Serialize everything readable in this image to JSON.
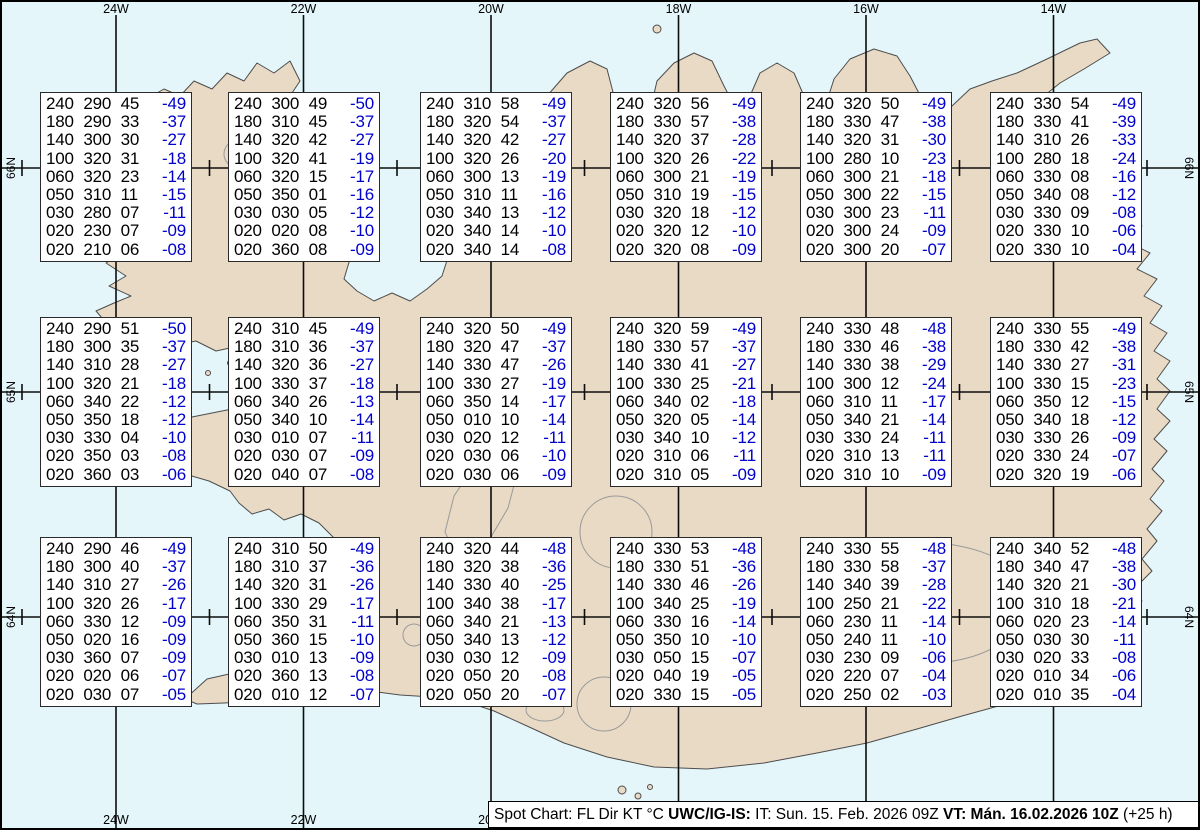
{
  "graticule": {
    "meridian_labels": [
      "24W",
      "22W",
      "20W",
      "18W",
      "16W",
      "14W"
    ],
    "parallel_labels": [
      "66N",
      "65N",
      "64N"
    ]
  },
  "legend": {
    "plain1": "Spot Chart: FL Dir KT °C ",
    "bold1": "UWC/IG-IS:",
    "plain2": " IT: Sun. 15. Feb. 2026 09Z ",
    "bold2": "VT: Mán. 16.02.2026 10Z",
    "plain3": " (+25 h)"
  },
  "colors": {
    "ocean": "#e4f6fa",
    "land": "#e9dac5",
    "coastline": "#4d4d4d",
    "glacier_outline": "#9a9a9a",
    "grid": "#0d0d0d",
    "temperature_blue": "#0000cc"
  },
  "columns": [
    "FL",
    "Dir",
    "KT",
    "°C"
  ],
  "spot_boxes": [
    {
      "row": 1,
      "col": 1,
      "rows": [
        [
          "240",
          "290",
          "45",
          "-49"
        ],
        [
          "180",
          "290",
          "33",
          "-37"
        ],
        [
          "140",
          "300",
          "30",
          "-27"
        ],
        [
          "100",
          "320",
          "31",
          "-18"
        ],
        [
          "060",
          "320",
          "23",
          "-14"
        ],
        [
          "050",
          "310",
          "11",
          "-15"
        ],
        [
          "030",
          "280",
          "07",
          "-11"
        ],
        [
          "020",
          "230",
          "07",
          "-09"
        ],
        [
          "020",
          "210",
          "06",
          "-08"
        ]
      ]
    },
    {
      "row": 1,
      "col": 2,
      "rows": [
        [
          "240",
          "300",
          "49",
          "-50"
        ],
        [
          "180",
          "310",
          "45",
          "-37"
        ],
        [
          "140",
          "320",
          "42",
          "-27"
        ],
        [
          "100",
          "320",
          "41",
          "-19"
        ],
        [
          "060",
          "320",
          "15",
          "-17"
        ],
        [
          "050",
          "350",
          "01",
          "-16"
        ],
        [
          "030",
          "030",
          "05",
          "-12"
        ],
        [
          "020",
          "020",
          "08",
          "-10"
        ],
        [
          "020",
          "360",
          "08",
          "-09"
        ]
      ]
    },
    {
      "row": 1,
      "col": 3,
      "rows": [
        [
          "240",
          "310",
          "58",
          "-49"
        ],
        [
          "180",
          "320",
          "54",
          "-37"
        ],
        [
          "140",
          "320",
          "42",
          "-27"
        ],
        [
          "100",
          "320",
          "26",
          "-20"
        ],
        [
          "060",
          "300",
          "13",
          "-19"
        ],
        [
          "050",
          "310",
          "11",
          "-16"
        ],
        [
          "030",
          "340",
          "13",
          "-12"
        ],
        [
          "020",
          "340",
          "14",
          "-10"
        ],
        [
          "020",
          "340",
          "14",
          "-08"
        ]
      ]
    },
    {
      "row": 1,
      "col": 4,
      "rows": [
        [
          "240",
          "320",
          "56",
          "-49"
        ],
        [
          "180",
          "330",
          "57",
          "-38"
        ],
        [
          "140",
          "320",
          "37",
          "-28"
        ],
        [
          "100",
          "320",
          "26",
          "-22"
        ],
        [
          "060",
          "300",
          "21",
          "-19"
        ],
        [
          "050",
          "310",
          "19",
          "-15"
        ],
        [
          "030",
          "320",
          "18",
          "-12"
        ],
        [
          "020",
          "320",
          "12",
          "-10"
        ],
        [
          "020",
          "320",
          "08",
          "-09"
        ]
      ]
    },
    {
      "row": 1,
      "col": 5,
      "rows": [
        [
          "240",
          "320",
          "50",
          "-49"
        ],
        [
          "180",
          "330",
          "47",
          "-38"
        ],
        [
          "140",
          "320",
          "31",
          "-30"
        ],
        [
          "100",
          "280",
          "10",
          "-23"
        ],
        [
          "060",
          "300",
          "21",
          "-18"
        ],
        [
          "050",
          "300",
          "22",
          "-15"
        ],
        [
          "030",
          "300",
          "23",
          "-11"
        ],
        [
          "020",
          "300",
          "24",
          "-09"
        ],
        [
          "020",
          "300",
          "20",
          "-07"
        ]
      ]
    },
    {
      "row": 1,
      "col": 6,
      "rows": [
        [
          "240",
          "330",
          "54",
          "-49"
        ],
        [
          "180",
          "330",
          "41",
          "-39"
        ],
        [
          "140",
          "310",
          "26",
          "-33"
        ],
        [
          "100",
          "280",
          "18",
          "-24"
        ],
        [
          "060",
          "330",
          "08",
          "-16"
        ],
        [
          "050",
          "340",
          "08",
          "-12"
        ],
        [
          "030",
          "330",
          "09",
          "-08"
        ],
        [
          "020",
          "330",
          "10",
          "-06"
        ],
        [
          "020",
          "330",
          "10",
          "-04"
        ]
      ]
    },
    {
      "row": 2,
      "col": 1,
      "rows": [
        [
          "240",
          "290",
          "51",
          "-50"
        ],
        [
          "180",
          "300",
          "35",
          "-37"
        ],
        [
          "140",
          "310",
          "28",
          "-27"
        ],
        [
          "100",
          "320",
          "21",
          "-18"
        ],
        [
          "060",
          "340",
          "22",
          "-12"
        ],
        [
          "050",
          "350",
          "18",
          "-12"
        ],
        [
          "030",
          "330",
          "04",
          "-10"
        ],
        [
          "020",
          "350",
          "03",
          "-08"
        ],
        [
          "020",
          "360",
          "03",
          "-06"
        ]
      ]
    },
    {
      "row": 2,
      "col": 2,
      "rows": [
        [
          "240",
          "310",
          "45",
          "-49"
        ],
        [
          "180",
          "310",
          "36",
          "-37"
        ],
        [
          "140",
          "320",
          "36",
          "-27"
        ],
        [
          "100",
          "330",
          "37",
          "-18"
        ],
        [
          "060",
          "340",
          "26",
          "-13"
        ],
        [
          "050",
          "340",
          "10",
          "-14"
        ],
        [
          "030",
          "010",
          "07",
          "-11"
        ],
        [
          "020",
          "030",
          "07",
          "-09"
        ],
        [
          "020",
          "040",
          "07",
          "-08"
        ]
      ]
    },
    {
      "row": 2,
      "col": 3,
      "rows": [
        [
          "240",
          "320",
          "50",
          "-49"
        ],
        [
          "180",
          "320",
          "47",
          "-37"
        ],
        [
          "140",
          "330",
          "47",
          "-26"
        ],
        [
          "100",
          "330",
          "27",
          "-19"
        ],
        [
          "060",
          "350",
          "14",
          "-17"
        ],
        [
          "050",
          "010",
          "10",
          "-14"
        ],
        [
          "030",
          "020",
          "12",
          "-11"
        ],
        [
          "020",
          "030",
          "06",
          "-10"
        ],
        [
          "020",
          "030",
          "06",
          "-09"
        ]
      ]
    },
    {
      "row": 2,
      "col": 4,
      "rows": [
        [
          "240",
          "320",
          "59",
          "-49"
        ],
        [
          "180",
          "330",
          "57",
          "-37"
        ],
        [
          "140",
          "330",
          "41",
          "-27"
        ],
        [
          "100",
          "330",
          "25",
          "-21"
        ],
        [
          "060",
          "340",
          "02",
          "-18"
        ],
        [
          "050",
          "320",
          "05",
          "-14"
        ],
        [
          "030",
          "340",
          "10",
          "-12"
        ],
        [
          "020",
          "310",
          "06",
          "-11"
        ],
        [
          "020",
          "310",
          "05",
          "-09"
        ]
      ]
    },
    {
      "row": 2,
      "col": 5,
      "rows": [
        [
          "240",
          "330",
          "48",
          "-48"
        ],
        [
          "180",
          "330",
          "46",
          "-38"
        ],
        [
          "140",
          "330",
          "38",
          "-29"
        ],
        [
          "100",
          "300",
          "12",
          "-24"
        ],
        [
          "060",
          "310",
          "11",
          "-17"
        ],
        [
          "050",
          "340",
          "21",
          "-14"
        ],
        [
          "030",
          "330",
          "24",
          "-11"
        ],
        [
          "020",
          "310",
          "13",
          "-11"
        ],
        [
          "020",
          "310",
          "10",
          "-09"
        ]
      ]
    },
    {
      "row": 2,
      "col": 6,
      "rows": [
        [
          "240",
          "330",
          "55",
          "-49"
        ],
        [
          "180",
          "330",
          "42",
          "-38"
        ],
        [
          "140",
          "330",
          "27",
          "-31"
        ],
        [
          "100",
          "330",
          "15",
          "-23"
        ],
        [
          "060",
          "350",
          "12",
          "-15"
        ],
        [
          "050",
          "340",
          "18",
          "-12"
        ],
        [
          "030",
          "330",
          "26",
          "-09"
        ],
        [
          "020",
          "330",
          "24",
          "-07"
        ],
        [
          "020",
          "320",
          "19",
          "-06"
        ]
      ]
    },
    {
      "row": 3,
      "col": 1,
      "rows": [
        [
          "240",
          "290",
          "46",
          "-49"
        ],
        [
          "180",
          "300",
          "40",
          "-37"
        ],
        [
          "140",
          "310",
          "27",
          "-26"
        ],
        [
          "100",
          "320",
          "26",
          "-17"
        ],
        [
          "060",
          "330",
          "12",
          "-09"
        ],
        [
          "050",
          "020",
          "16",
          "-09"
        ],
        [
          "030",
          "360",
          "07",
          "-09"
        ],
        [
          "020",
          "020",
          "06",
          "-07"
        ],
        [
          "020",
          "030",
          "07",
          "-05"
        ]
      ]
    },
    {
      "row": 3,
      "col": 2,
      "rows": [
        [
          "240",
          "310",
          "50",
          "-49"
        ],
        [
          "180",
          "310",
          "37",
          "-36"
        ],
        [
          "140",
          "320",
          "31",
          "-26"
        ],
        [
          "100",
          "330",
          "29",
          "-17"
        ],
        [
          "060",
          "350",
          "31",
          "-11"
        ],
        [
          "050",
          "360",
          "15",
          "-10"
        ],
        [
          "030",
          "010",
          "13",
          "-09"
        ],
        [
          "020",
          "360",
          "13",
          "-08"
        ],
        [
          "020",
          "010",
          "12",
          "-07"
        ]
      ]
    },
    {
      "row": 3,
      "col": 3,
      "rows": [
        [
          "240",
          "320",
          "44",
          "-48"
        ],
        [
          "180",
          "320",
          "38",
          "-36"
        ],
        [
          "140",
          "330",
          "40",
          "-25"
        ],
        [
          "100",
          "340",
          "38",
          "-17"
        ],
        [
          "060",
          "340",
          "21",
          "-13"
        ],
        [
          "050",
          "340",
          "13",
          "-12"
        ],
        [
          "030",
          "030",
          "12",
          "-09"
        ],
        [
          "020",
          "050",
          "20",
          "-08"
        ],
        [
          "020",
          "050",
          "20",
          "-07"
        ]
      ]
    },
    {
      "row": 3,
      "col": 4,
      "rows": [
        [
          "240",
          "330",
          "53",
          "-48"
        ],
        [
          "180",
          "330",
          "51",
          "-36"
        ],
        [
          "140",
          "330",
          "46",
          "-26"
        ],
        [
          "100",
          "340",
          "25",
          "-19"
        ],
        [
          "060",
          "330",
          "16",
          "-14"
        ],
        [
          "050",
          "350",
          "10",
          "-10"
        ],
        [
          "030",
          "050",
          "15",
          "-07"
        ],
        [
          "020",
          "040",
          "19",
          "-05"
        ],
        [
          "020",
          "330",
          "15",
          "-05"
        ]
      ]
    },
    {
      "row": 3,
      "col": 5,
      "rows": [
        [
          "240",
          "330",
          "55",
          "-48"
        ],
        [
          "180",
          "330",
          "58",
          "-37"
        ],
        [
          "140",
          "340",
          "39",
          "-28"
        ],
        [
          "100",
          "250",
          "21",
          "-22"
        ],
        [
          "060",
          "230",
          "11",
          "-14"
        ],
        [
          "050",
          "240",
          "11",
          "-10"
        ],
        [
          "030",
          "230",
          "09",
          "-06"
        ],
        [
          "020",
          "220",
          "07",
          "-04"
        ],
        [
          "020",
          "250",
          "02",
          "-03"
        ]
      ]
    },
    {
      "row": 3,
      "col": 6,
      "rows": [
        [
          "240",
          "340",
          "52",
          "-48"
        ],
        [
          "180",
          "340",
          "47",
          "-38"
        ],
        [
          "140",
          "320",
          "21",
          "-30"
        ],
        [
          "100",
          "310",
          "18",
          "-21"
        ],
        [
          "060",
          "020",
          "23",
          "-14"
        ],
        [
          "050",
          "030",
          "30",
          "-11"
        ],
        [
          "030",
          "020",
          "33",
          "-08"
        ],
        [
          "020",
          "010",
          "34",
          "-06"
        ],
        [
          "020",
          "010",
          "35",
          "-04"
        ]
      ]
    }
  ]
}
